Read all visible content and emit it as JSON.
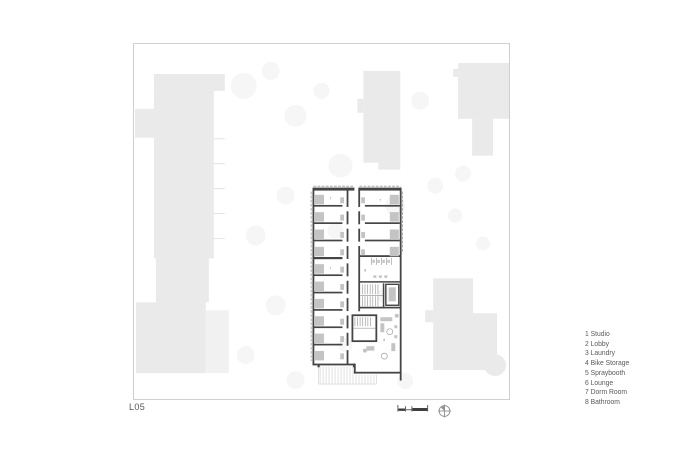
{
  "sheet": {
    "label": "L05"
  },
  "legend": {
    "items": [
      "1 Studio",
      "2 Lobby",
      "3 Laundry",
      "4 Bike Storage",
      "5 Spraybooth",
      "6 Lounge",
      "7 Dorm Room",
      "8 Bathroom"
    ]
  },
  "plan_labels": [
    "7",
    "7",
    "7",
    "8",
    "6"
  ],
  "icons": {
    "scale_bar": "scale-bar",
    "north_arrow": "north-arrow"
  },
  "colors": {
    "frame_border": "#cfcfcf",
    "context_building": "#eaeaea",
    "context_building_light": "#f1f1f1",
    "ground_texture": "#f6f6f6",
    "plan_wall": "#454545",
    "furniture": "#c4c4c4",
    "fixture": "#9e9e9e",
    "text": "#58595b"
  }
}
